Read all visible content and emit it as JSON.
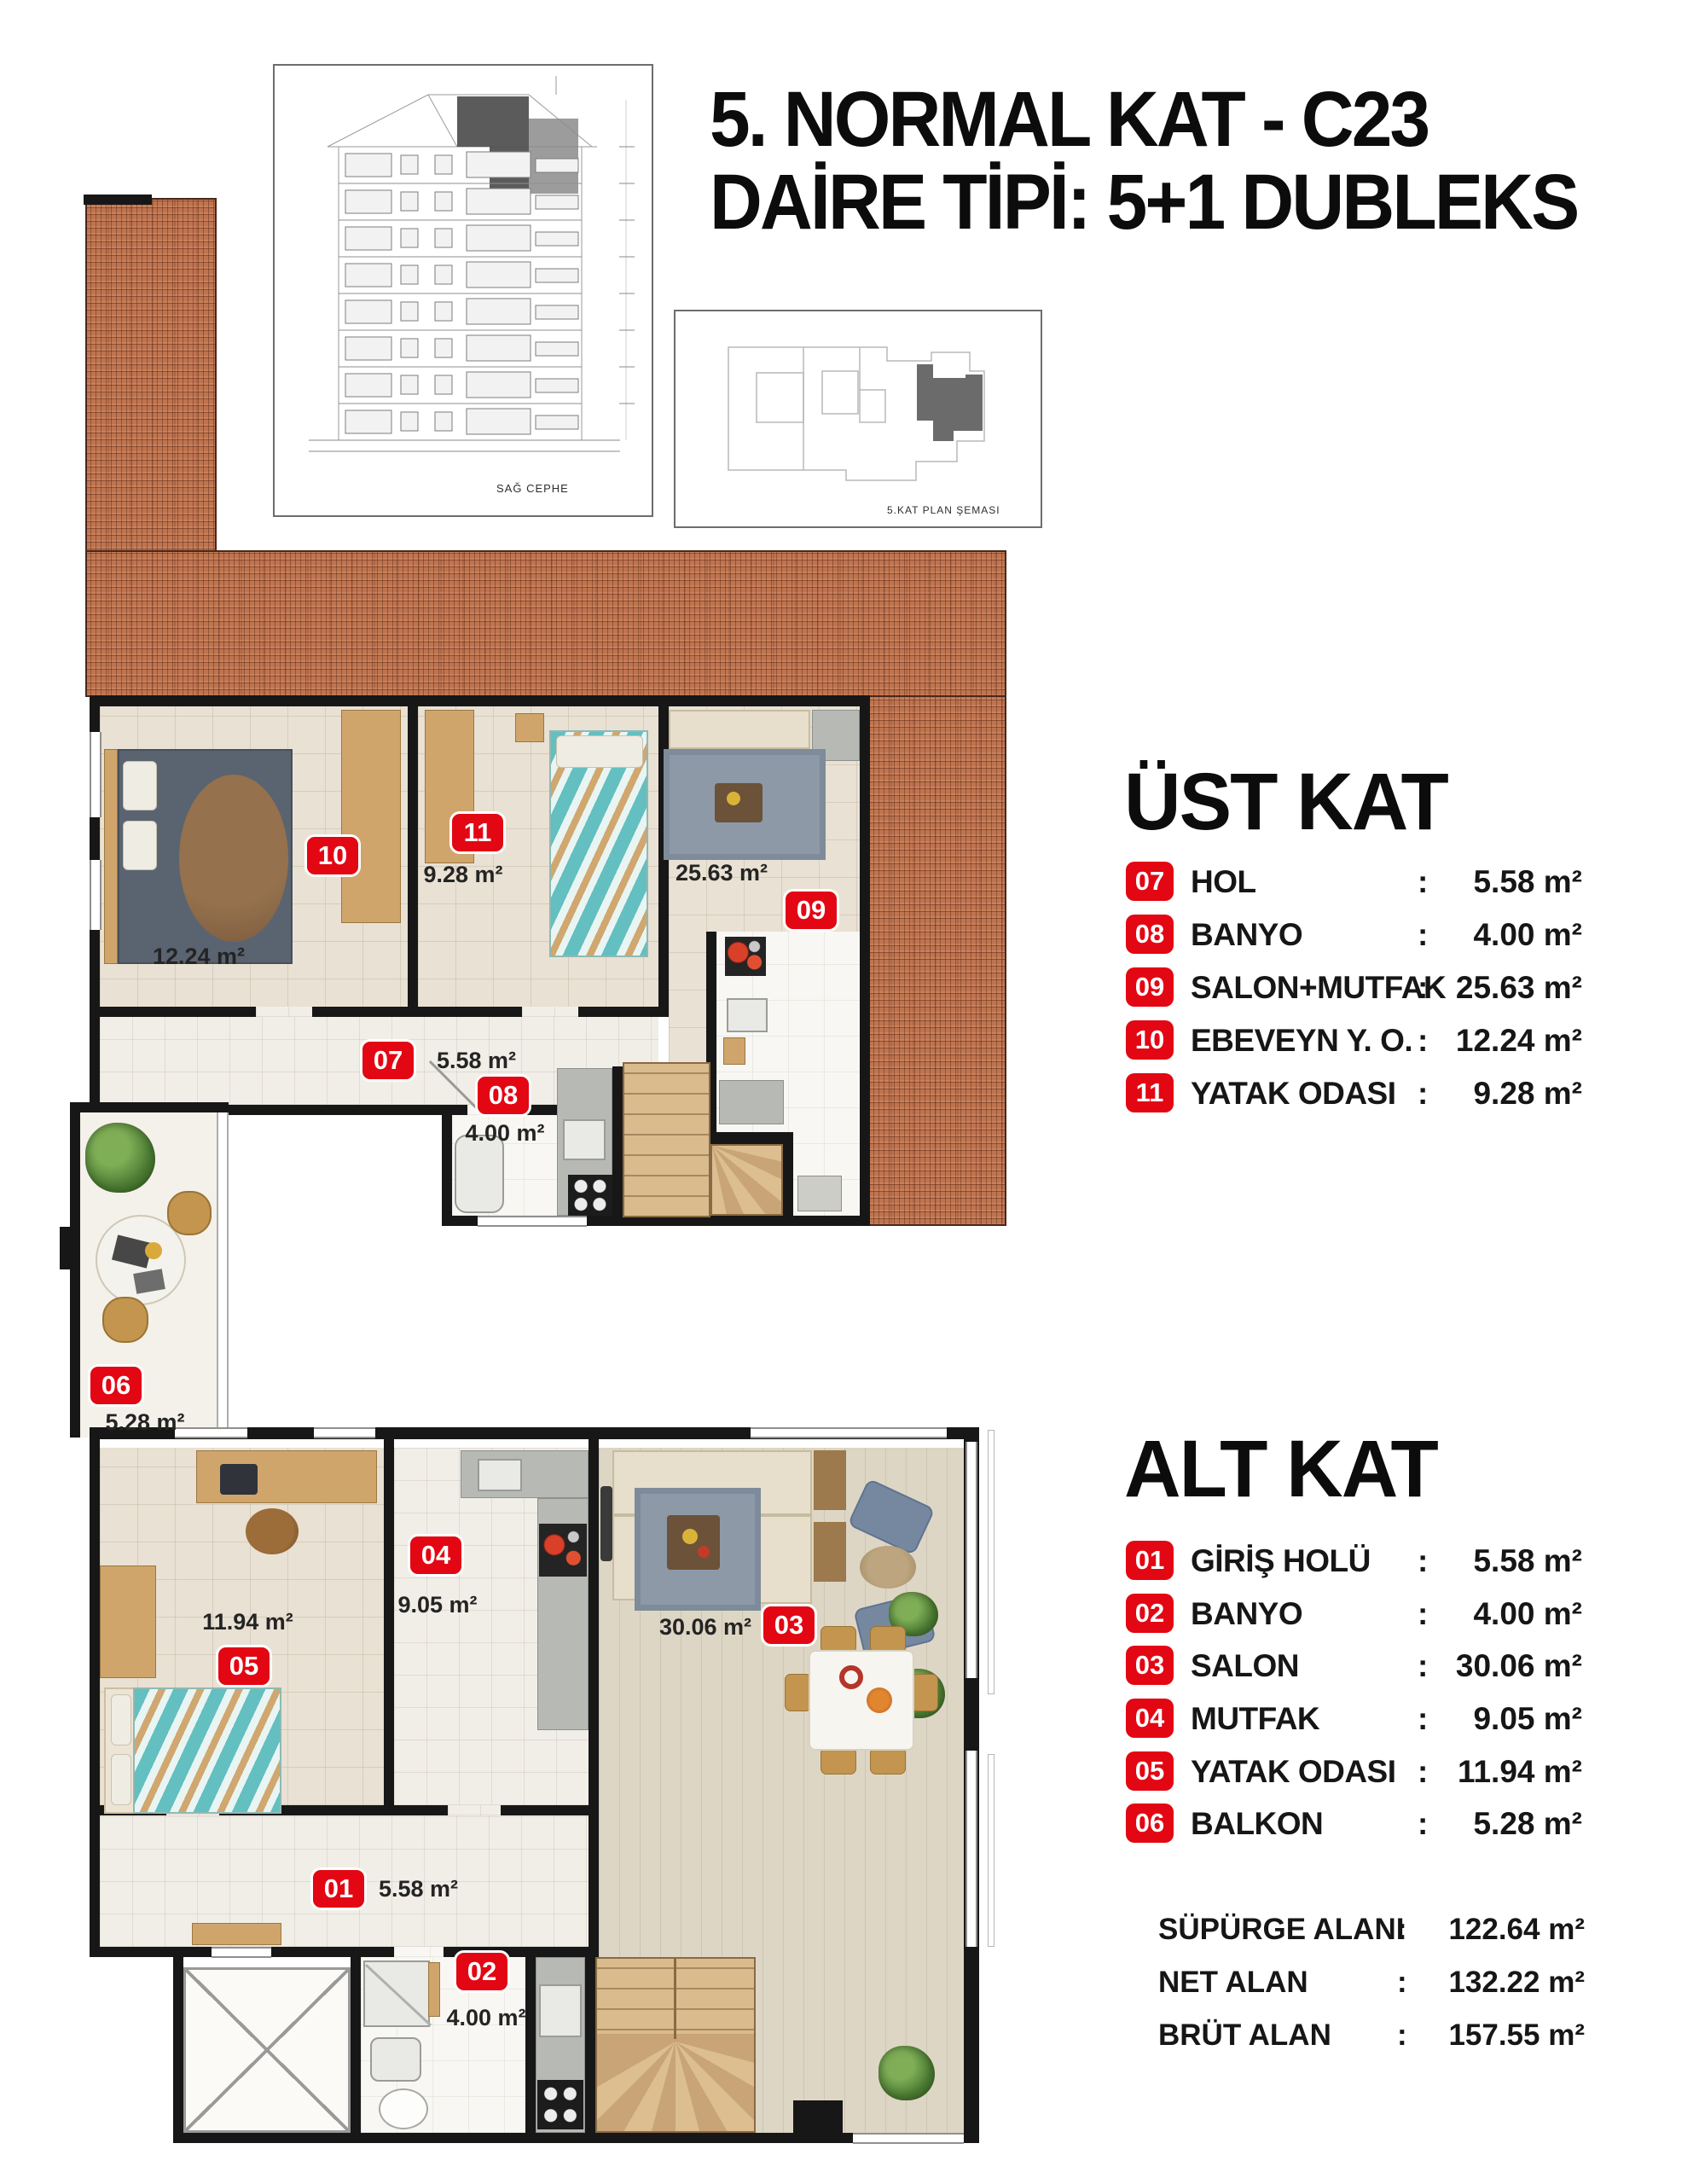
{
  "ui": {
    "colon": ":"
  },
  "header": {
    "title_line1": "5. NORMAL KAT - C23",
    "title_line2": "DAİRE TİPİ: 5+1 DUBLEKS"
  },
  "drawings": {
    "elevation_label": "SAĞ CEPHE",
    "plan_schema_label": "5.KAT PLAN ŞEMASI"
  },
  "upper_floor": {
    "section_title": "ÜST KAT",
    "rooms": [
      {
        "num": "07",
        "name": "HOL",
        "area": "5.58 m²"
      },
      {
        "num": "08",
        "name": "BANYO",
        "area": "4.00 m²"
      },
      {
        "num": "09",
        "name": "SALON+MUTFAK",
        "area": "25.63 m²"
      },
      {
        "num": "10",
        "name": "EBEVEYN Y. O.",
        "area": "12.24 m²"
      },
      {
        "num": "11",
        "name": "YATAK ODASI",
        "area": "9.28 m²"
      }
    ]
  },
  "lower_floor": {
    "section_title": "ALT KAT",
    "rooms": [
      {
        "num": "01",
        "name": "GİRİŞ HOLÜ",
        "area": "5.58 m²"
      },
      {
        "num": "02",
        "name": "BANYO",
        "area": "4.00 m²"
      },
      {
        "num": "03",
        "name": "SALON",
        "area": "30.06 m²"
      },
      {
        "num": "04",
        "name": "MUTFAK",
        "area": "9.05 m²"
      },
      {
        "num": "05",
        "name": "YATAK ODASI",
        "area": "11.94 m²"
      },
      {
        "num": "06",
        "name": "BALKON",
        "area": "5.28 m²"
      }
    ]
  },
  "summary": [
    {
      "label": "SÜPÜRGE ALANI",
      "value": "122.64 m²"
    },
    {
      "label": "NET ALAN",
      "value": "132.22 m²"
    },
    {
      "label": "BRÜT ALAN",
      "value": "157.55 m²"
    }
  ],
  "colors": {
    "badge_red": "#e30613",
    "roof_tile": "#bf7450",
    "wall": "#171717"
  }
}
